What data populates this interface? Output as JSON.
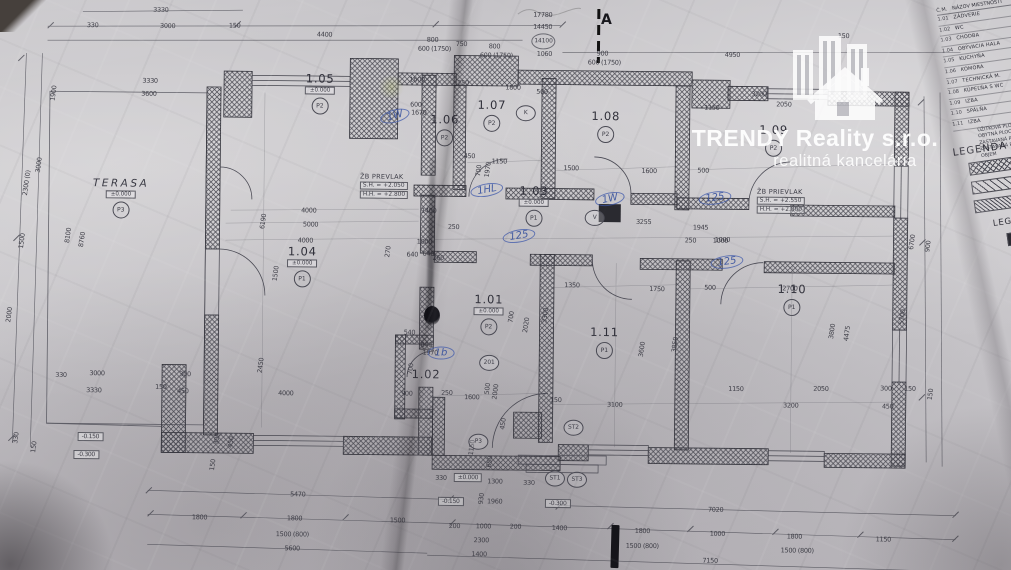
{
  "watermark": {
    "company": "TRENDY Reality s.r.o.",
    "tagline": "realitná kancelária"
  },
  "plan": {
    "section_label": "A",
    "rooms": [
      {
        "number": "1.01",
        "level": "±0.000",
        "floor": "P2",
        "x": 489,
        "y": 314
      },
      {
        "number": "1.02",
        "x": 427,
        "y": 375
      },
      {
        "number": "1.03",
        "level": "±0.000",
        "floor": "P1",
        "x": 533,
        "y": 205
      },
      {
        "number": "1.04",
        "level": "±0.000",
        "floor": "P1",
        "x": 302,
        "y": 268
      },
      {
        "number": "1.05",
        "level": "±0.000",
        "floor": "P2",
        "x": 318,
        "y": 95
      },
      {
        "number": "1.06",
        "floor": "P2",
        "x": 443,
        "y": 130
      },
      {
        "number": "1.07",
        "floor": "P2",
        "x": 490,
        "y": 115
      },
      {
        "number": "1.08",
        "floor": "P2",
        "x": 604,
        "y": 125
      },
      {
        "number": "1.09",
        "floor": "P2",
        "x": 772,
        "y": 137
      },
      {
        "number": "1.10",
        "floor": "P1",
        "x": 792,
        "y": 296
      },
      {
        "number": "1.11",
        "floor": "P1",
        "x": 605,
        "y": 341
      },
      {
        "name": "TERASA",
        "level": "±0.000",
        "floor": "P3",
        "x": 120,
        "y": 202
      }
    ],
    "beams": [
      {
        "l1": "ŽB PREVLAK",
        "l2": "S.H. = +2.050",
        "l3": "H.H. = +2.800",
        "x": 383,
        "y": 187
      },
      {
        "l1": "ŽB PRIEVLAK",
        "l2": "S.H. = +2.550",
        "l3": "H.H. = +2.800",
        "x": 780,
        "y": 198
      }
    ],
    "markers": [
      {
        "t": "K",
        "x": 524,
        "y": 113
      },
      {
        "t": "V",
        "x": 594,
        "y": 217
      },
      {
        "t": "201",
        "x": 490,
        "y": 363
      },
      {
        "t": "ST1",
        "x": 557,
        "y": 478
      },
      {
        "t": "ST2",
        "x": 575,
        "y": 427
      },
      {
        "t": "ST3",
        "x": 579,
        "y": 479
      },
      {
        "t": "P3",
        "x": 480,
        "y": 442
      },
      {
        "t": "14100",
        "x": 541,
        "y": 41,
        "pencil": true
      }
    ],
    "level_boxes": [
      {
        "t": "±0.000",
        "x": 470,
        "y": 478
      },
      {
        "t": "-0.150",
        "x": 453,
        "y": 502
      },
      {
        "t": "-0.300",
        "x": 560,
        "y": 503
      },
      {
        "t": "-0.150",
        "x": 92,
        "y": 441
      },
      {
        "t": "-0.300",
        "x": 88,
        "y": 459
      }
    ],
    "dims": [
      [
        "3330",
        158,
        14
      ],
      [
        "330",
        90,
        30
      ],
      [
        "3000",
        165,
        30
      ],
      [
        "150",
        232,
        29
      ],
      [
        "4400",
        322,
        37
      ],
      [
        "800",
        430,
        41
      ],
      [
        "600 (1750)",
        432,
        50
      ],
      [
        "750",
        459,
        45
      ],
      [
        "800",
        492,
        47
      ],
      [
        "600 (1750)",
        494,
        56
      ],
      [
        "17780",
        540,
        15
      ],
      [
        "14450",
        540,
        27
      ],
      [
        "1060",
        542,
        54
      ],
      [
        "900",
        600,
        53
      ],
      [
        "600 (1750)",
        602,
        62
      ],
      [
        "4950",
        730,
        53
      ],
      [
        "150",
        841,
        33
      ],
      [
        "3200",
        757,
        92
      ],
      [
        "1150",
        710,
        106
      ],
      [
        "2050",
        782,
        102
      ],
      [
        "1600",
        415,
        81
      ],
      [
        "250",
        461,
        84
      ],
      [
        "1800",
        511,
        88
      ],
      [
        "500",
        540,
        92
      ],
      [
        "600",
        414,
        106
      ],
      [
        "1670",
        417,
        114
      ],
      [
        "3330",
        148,
        85
      ],
      [
        "3600",
        147,
        98
      ],
      [
        "1900",
        52,
        98,
        -83
      ],
      [
        "3000",
        38,
        170,
        -83
      ],
      [
        "2300 (0)",
        26,
        188,
        -83
      ],
      [
        "1500",
        22,
        246,
        -83
      ],
      [
        "2000",
        10,
        320,
        -83
      ],
      [
        "8100",
        68,
        240,
        -83
      ],
      [
        "8760",
        82,
        244,
        -83
      ],
      [
        "330",
        18,
        443,
        -83
      ],
      [
        "150",
        36,
        452,
        -83
      ],
      [
        "6190",
        263,
        224,
        -83
      ],
      [
        "2450",
        262,
        368,
        -83
      ],
      [
        "1500",
        276,
        276,
        -83
      ],
      [
        "4000",
        308,
        213
      ],
      [
        "5000",
        310,
        227
      ],
      [
        "4000",
        305,
        243
      ],
      [
        "4000",
        287,
        396
      ],
      [
        "1150",
        498,
        162
      ],
      [
        "1500",
        570,
        168
      ],
      [
        "450",
        468,
        157
      ],
      [
        "700",
        478,
        171,
        -83
      ],
      [
        "1970",
        487,
        170,
        -83
      ],
      [
        "1400",
        428,
        212
      ],
      [
        "250",
        453,
        228
      ],
      [
        "1000",
        424,
        243
      ],
      [
        "270",
        388,
        253,
        -83
      ],
      [
        "640",
        428,
        255
      ],
      [
        "3255",
        643,
        221
      ],
      [
        "1945",
        700,
        226
      ],
      [
        "1000",
        722,
        238
      ],
      [
        "1600",
        648,
        170
      ],
      [
        "500",
        702,
        169
      ],
      [
        "640",
        412,
        256
      ],
      [
        "260",
        438,
        259
      ],
      [
        "540",
        410,
        334
      ],
      [
        "640",
        427,
        346
      ],
      [
        "1970",
        431,
        354
      ],
      [
        "900",
        408,
        395
      ],
      [
        "250",
        448,
        394
      ],
      [
        "1600",
        473,
        398
      ],
      [
        "500",
        489,
        389,
        -83
      ],
      [
        "2000",
        497,
        392,
        -83
      ],
      [
        "700",
        412,
        370,
        -83
      ],
      [
        "2020",
        527,
        325,
        -83
      ],
      [
        "700",
        512,
        317,
        -83
      ],
      [
        "3300",
        546,
        315,
        -83
      ],
      [
        "1350",
        572,
        285
      ],
      [
        "1750",
        657,
        288
      ],
      [
        "500",
        710,
        286
      ],
      [
        "3600",
        643,
        348,
        -83
      ],
      [
        "3850",
        676,
        343,
        -83
      ],
      [
        "3100",
        616,
        404
      ],
      [
        "1000",
        720,
        239
      ],
      [
        "250",
        690,
        239
      ],
      [
        "2700",
        790,
        286
      ],
      [
        "3800",
        833,
        328,
        -83
      ],
      [
        "4475",
        848,
        330,
        -83
      ],
      [
        "1150",
        737,
        387
      ],
      [
        "2050",
        822,
        386
      ],
      [
        "3200",
        792,
        403
      ],
      [
        "300",
        887,
        385
      ],
      [
        "150",
        911,
        385
      ],
      [
        "450",
        889,
        403
      ],
      [
        "6700",
        912,
        238,
        -83
      ],
      [
        "900",
        928,
        242,
        -83
      ],
      [
        "5700",
        903,
        313,
        -83
      ],
      [
        "150",
        932,
        390,
        -83
      ],
      [
        "330",
        443,
        479
      ],
      [
        "1300",
        497,
        482
      ],
      [
        "330",
        531,
        483
      ],
      [
        "1960",
        497,
        502
      ],
      [
        "930",
        484,
        499,
        -83
      ],
      [
        "1150",
        474,
        448,
        -83
      ],
      [
        "650",
        492,
        462,
        -83
      ],
      [
        "450",
        505,
        424,
        -83
      ],
      [
        "150",
        557,
        400
      ],
      [
        "330",
        62,
        380
      ],
      [
        "3000",
        98,
        378
      ],
      [
        "3330",
        95,
        395
      ],
      [
        "150",
        162,
        391
      ],
      [
        "300",
        186,
        378
      ],
      [
        "450",
        184,
        395
      ],
      [
        "300",
        219,
        442,
        -83
      ],
      [
        "450",
        233,
        445,
        -83
      ],
      [
        "150",
        215,
        468,
        -83
      ],
      [
        "5470",
        300,
        497
      ],
      [
        "1800",
        202,
        521
      ],
      [
        "1800",
        297,
        521
      ],
      [
        "1500",
        400,
        522
      ],
      [
        "1500 (800)",
        295,
        537
      ],
      [
        "5600",
        295,
        551
      ],
      [
        "200",
        457,
        527
      ],
      [
        "1000",
        486,
        527
      ],
      [
        "2300",
        484,
        541
      ],
      [
        "1400",
        482,
        555
      ],
      [
        "7020",
        718,
        508
      ],
      [
        "200",
        518,
        527
      ],
      [
        "1400",
        562,
        528
      ],
      [
        "1800",
        645,
        530
      ],
      [
        "1000",
        720,
        532
      ],
      [
        "1800",
        797,
        534
      ],
      [
        "1150",
        886,
        536
      ],
      [
        "1500 (800)",
        645,
        545
      ],
      [
        "1500 (800)",
        800,
        548
      ],
      [
        "7150",
        713,
        559
      ]
    ]
  },
  "pen_notes": [
    {
      "t": "1W",
      "x": 395,
      "y": 116,
      "r": -15
    },
    {
      "t": "1HL",
      "x": 487,
      "y": 190,
      "r": -10
    },
    {
      "t": "1W",
      "x": 610,
      "y": 199,
      "r": -12
    },
    {
      "t": "125",
      "x": 715,
      "y": 198,
      "r": -8
    },
    {
      "t": "125",
      "x": 519,
      "y": 236,
      "r": -10
    },
    {
      "t": "125",
      "x": 727,
      "y": 262,
      "r": -8
    },
    {
      "t": "1b",
      "x": 441,
      "y": 353,
      "r": 0
    }
  ],
  "table": {
    "col_num": "Č.M.",
    "col_name": "NÁZOV MIESTNOSTI",
    "rows": [
      {
        "num": "1.01",
        "name": "ZÁDVERIE"
      },
      {
        "num": "1.02",
        "name": "WC"
      },
      {
        "num": "1.03",
        "name": "CHODBA"
      },
      {
        "num": "1.04",
        "name": "OBÝVACIA HALA"
      },
      {
        "num": "1.05",
        "name": "KUCHYŇA"
      },
      {
        "num": "1.06",
        "name": "KOMORA"
      },
      {
        "num": "1.07",
        "name": "TECHNICKÁ M."
      },
      {
        "num": "1.08",
        "name": "KÚPEĽŇA S WC"
      },
      {
        "num": "1.09",
        "name": "IZBA"
      },
      {
        "num": "1.10",
        "name": "SPÁLŇA"
      },
      {
        "num": "1.11",
        "name": "IZBA"
      }
    ],
    "summary": [
      "ÚŽITKOVÁ PLOCHA",
      "OBYTNÁ PLOCHA",
      "ZASTAVANÁ PLOCHA",
      "ZASTAVANÁ PLOCHA",
      "OBJEM"
    ]
  },
  "legend": {
    "title": "LEGENDA",
    "title2": "LEGENDA"
  }
}
